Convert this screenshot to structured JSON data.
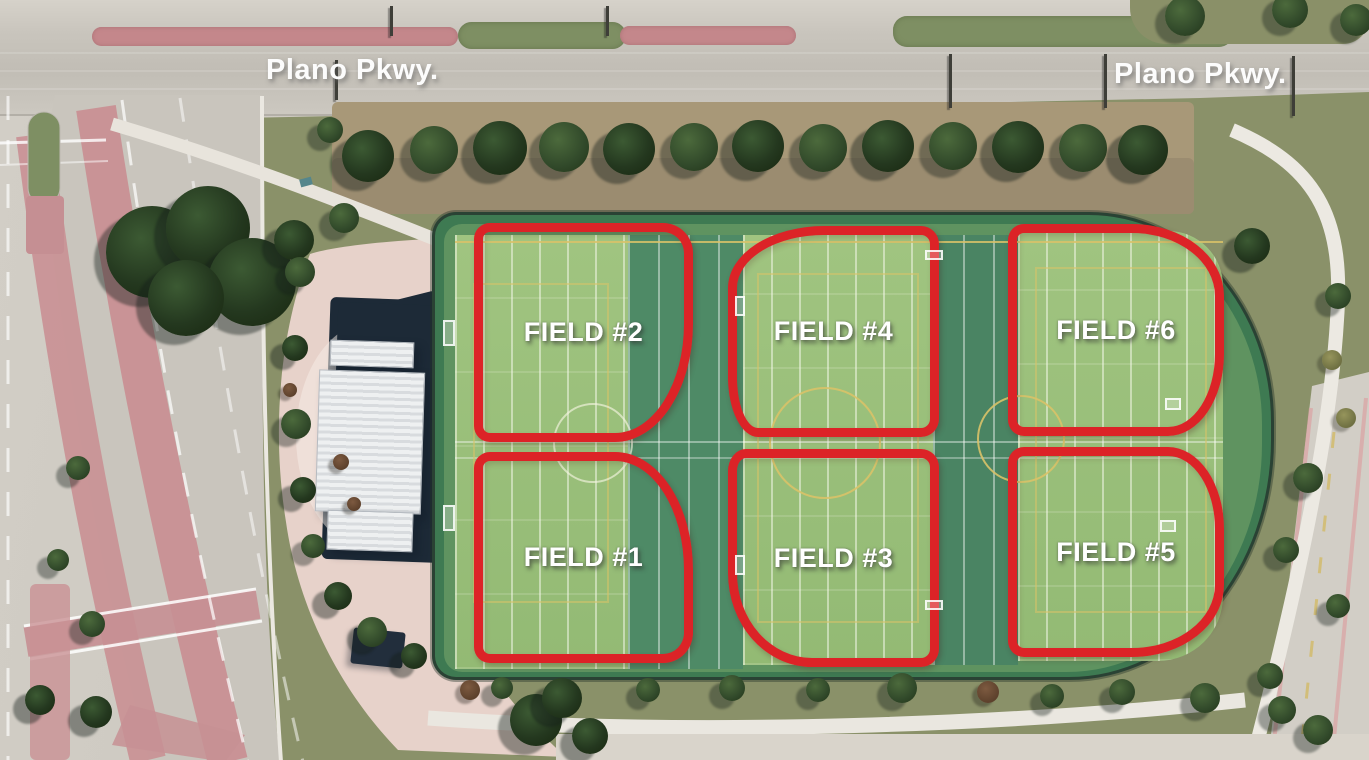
{
  "street_labels": [
    {
      "text": "Plano Pkwy."
    },
    {
      "text": "Plano Pkwy."
    }
  ],
  "fields": [
    {
      "label": "FIELD #1"
    },
    {
      "label": "FIELD #2"
    },
    {
      "label": "FIELD #3"
    },
    {
      "label": "FIELD #4"
    },
    {
      "label": "FIELD #5"
    },
    {
      "label": "FIELD #6"
    }
  ],
  "colors": {
    "field_outline_red": "#dc2327",
    "label_text": "#ffffff",
    "turf_green": "#3e7a52",
    "field_panel_green": "#9cc07d"
  }
}
